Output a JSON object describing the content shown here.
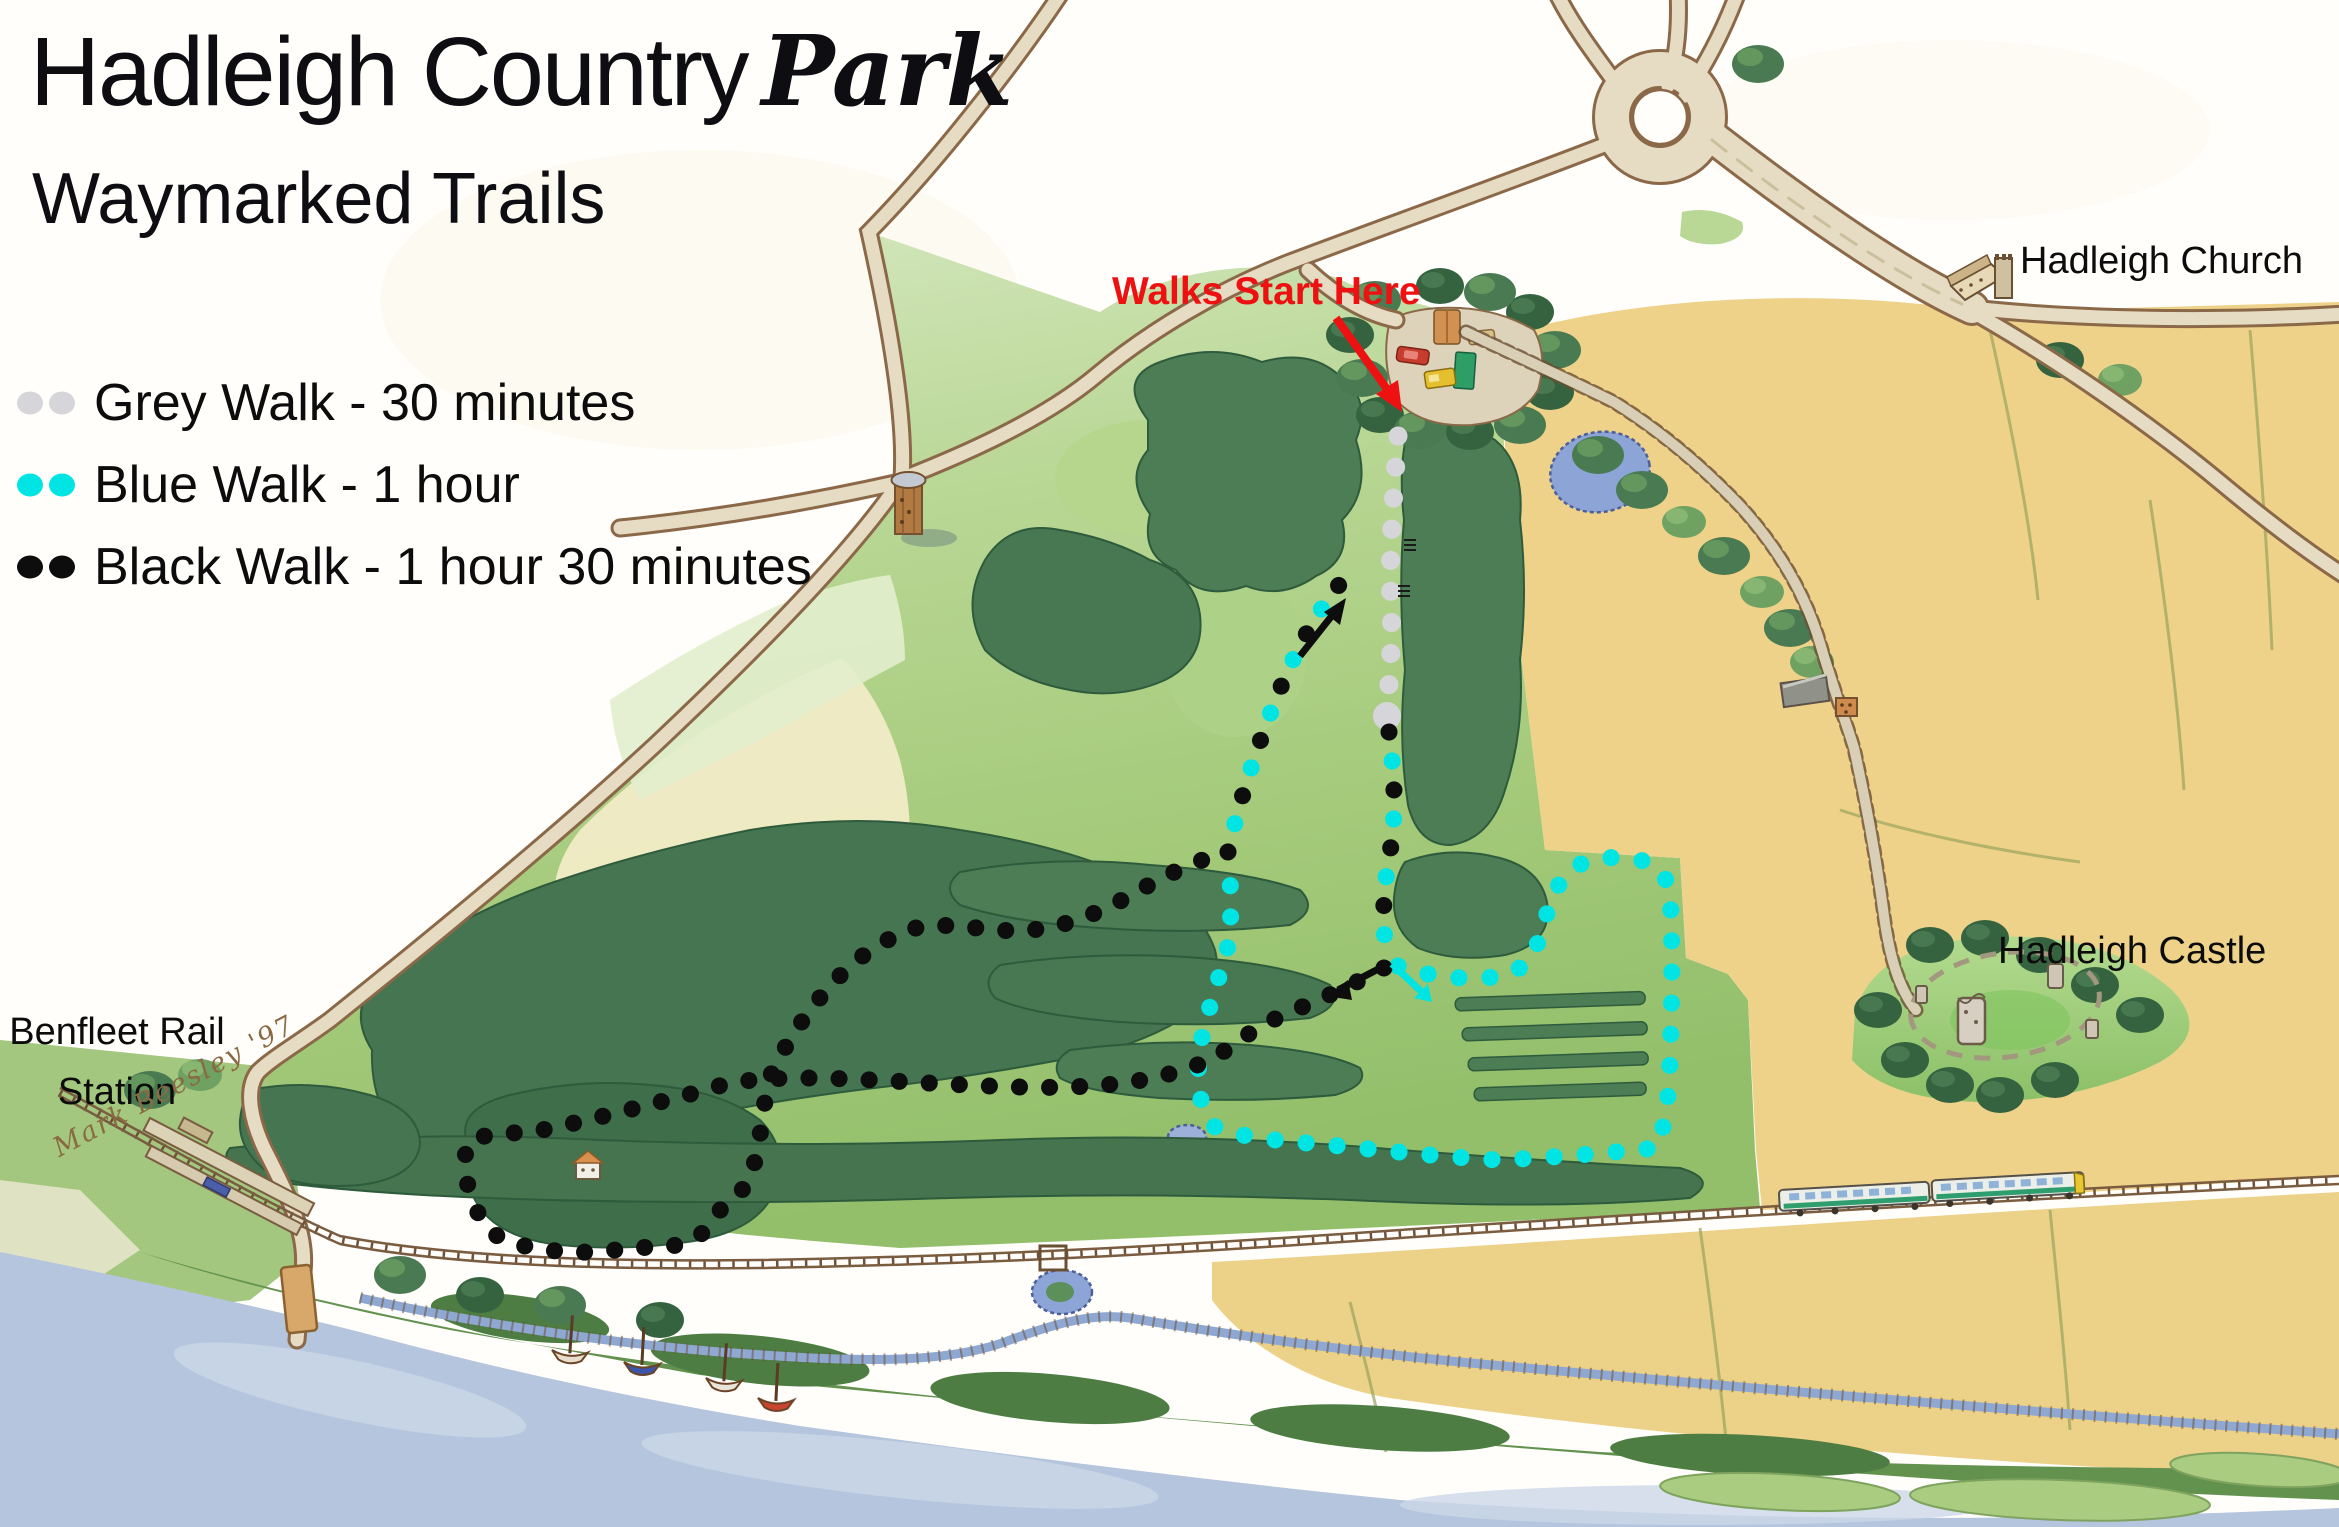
{
  "title": {
    "main": "Hadleigh Country",
    "script": "Park"
  },
  "subtitle": "Waymarked Trails",
  "legend": {
    "items": [
      {
        "name": "grey-walk",
        "label": "Grey Walk - 30 minutes",
        "duration": "30 minutes",
        "color": "#d6d6da"
      },
      {
        "name": "blue-walk",
        "label": "Blue Walk - 1 hour",
        "duration": "1 hour",
        "color": "#00e4e4"
      },
      {
        "name": "black-walk",
        "label": "Black Walk - 1 hour 30 minutes",
        "duration": "1 hour 30 minutes",
        "color": "#0d0d0d"
      }
    ]
  },
  "labels": {
    "walks_start": "Walks Start Here",
    "church": "Hadleigh Church",
    "castle": "Hadleigh Castle",
    "station_line1": "Benfleet Rail",
    "station_line2": "Station",
    "signature": "Mark Beesley '97"
  },
  "colors": {
    "trail_grey": "#d6d6da",
    "trail_blue": "#00e4e4",
    "trail_black": "#0d0d0d",
    "start_red": "#ee1111",
    "field_tan": "#eed289",
    "park_green": "#a6cb7d",
    "woods_green": "#47764f",
    "water_blue": "#b5c5dd",
    "road_fill": "#e6dcc4"
  }
}
